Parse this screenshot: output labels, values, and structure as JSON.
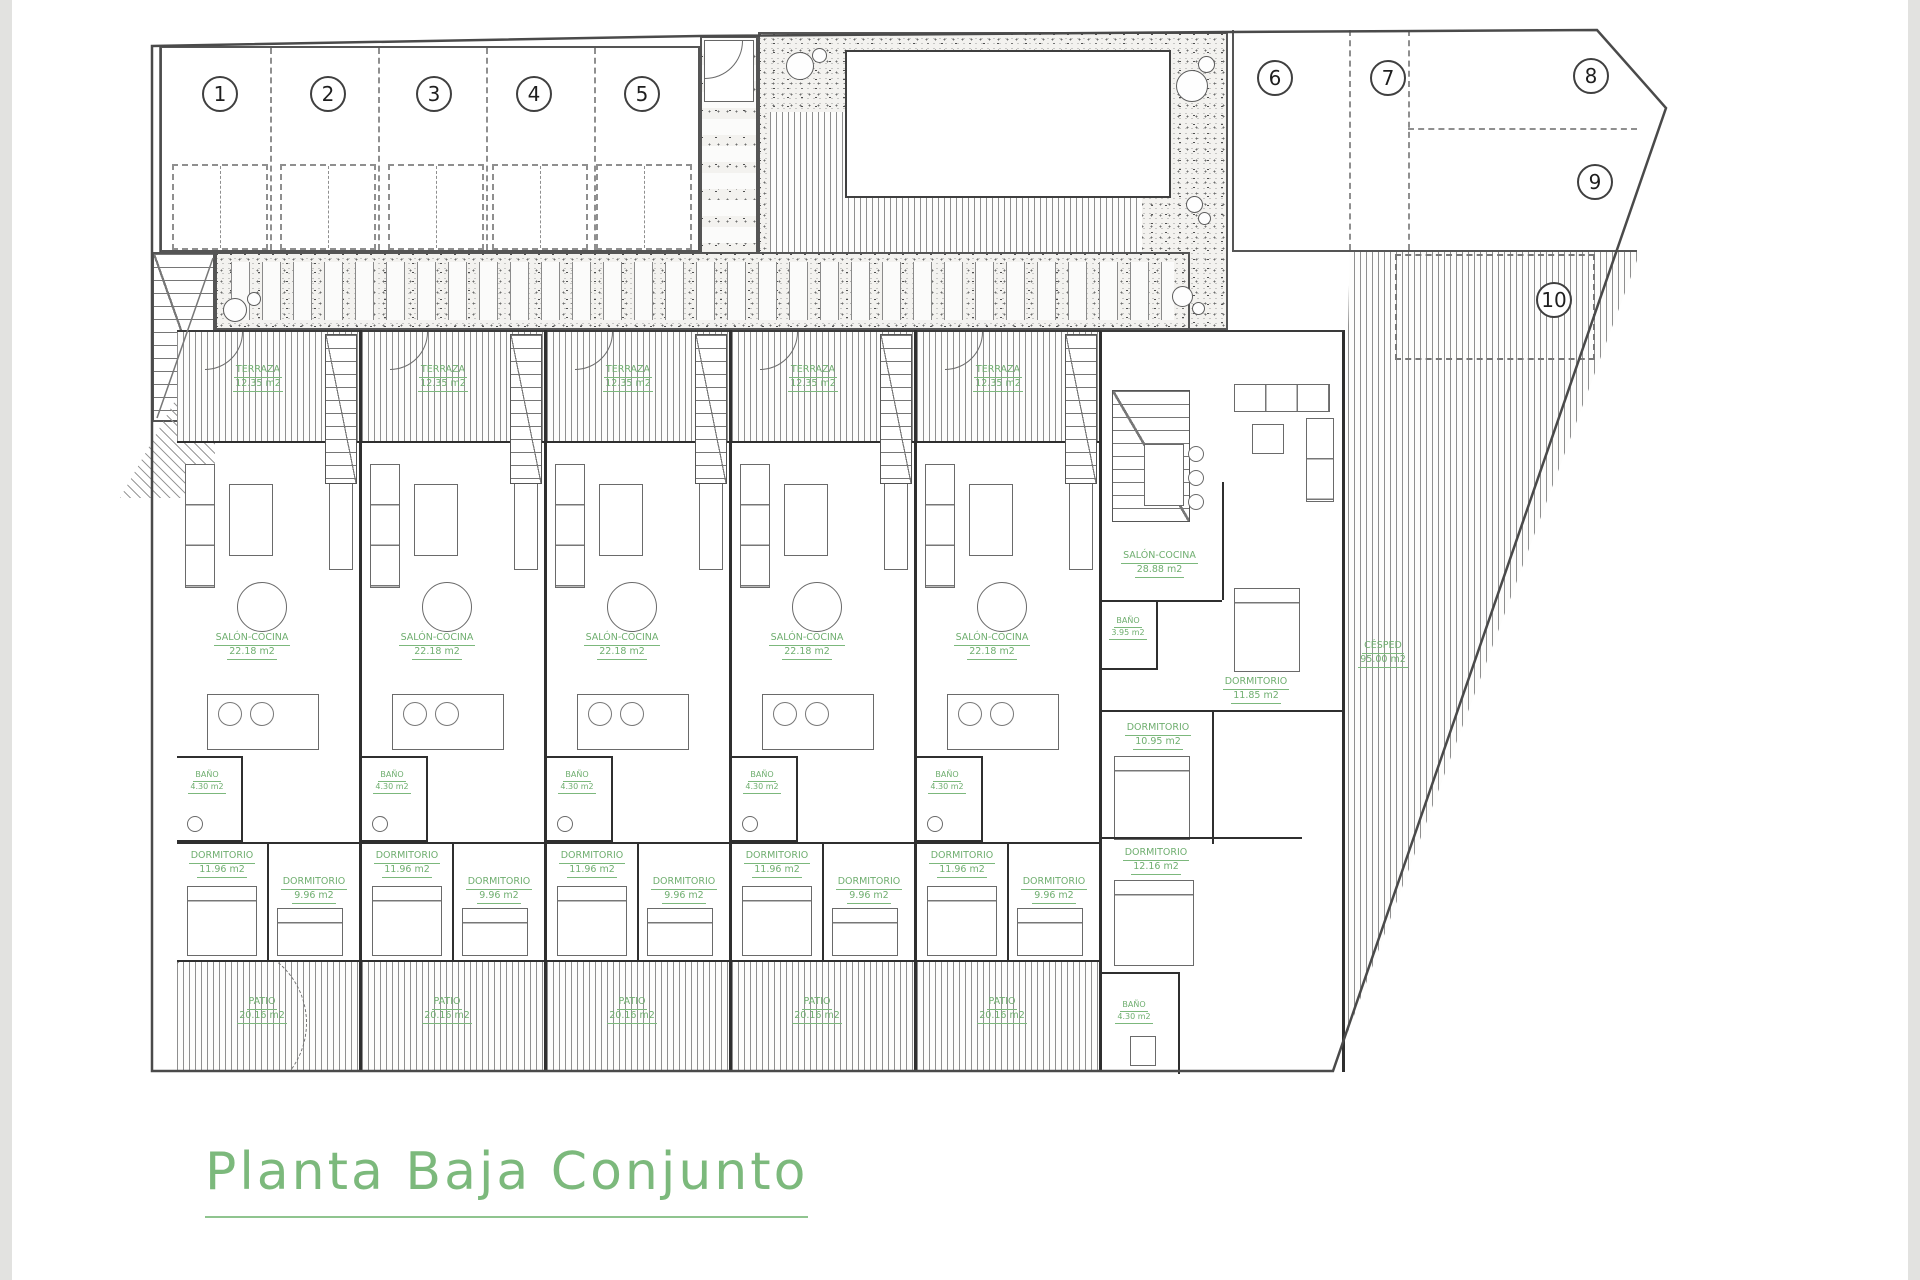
{
  "title": "Planta Baja Conjunto",
  "plot": {
    "parking_numbers": [
      "1",
      "2",
      "3",
      "4",
      "5",
      "6",
      "7",
      "8",
      "9",
      "10"
    ]
  },
  "unit": {
    "terraza": {
      "name": "TERRAZA",
      "area": "12.35 m2"
    },
    "salon": {
      "name": "SALÓN-COCINA",
      "area": "22.18 m2"
    },
    "bano": {
      "name": "BAÑO",
      "area": "4.30 m2"
    },
    "dorm1": {
      "name": "DORMITORIO",
      "area": "11.96 m2"
    },
    "dorm2": {
      "name": "DORMITORIO",
      "area": "9.96 m2"
    },
    "patio": {
      "name": "PATIO",
      "area": "20.16 m2"
    }
  },
  "end_unit": {
    "salon": {
      "name": "SALÓN-COCINA",
      "area": "28.88 m2"
    },
    "bano1": {
      "name": "BAÑO",
      "area": "3.95 m2"
    },
    "dorm1": {
      "name": "DORMITORIO",
      "area": "11.85 m2"
    },
    "dorm2": {
      "name": "DORMITORIO",
      "area": "10.95 m2"
    },
    "dorm3": {
      "name": "DORMITORIO",
      "area": "12.16 m2"
    },
    "bano2": {
      "name": "BAÑO",
      "area": "4.30 m2"
    },
    "cesped": {
      "name": "CÉSPED",
      "area": "95.00 m2"
    }
  },
  "colors": {
    "label_green": "#6fae6f",
    "title_green": "#7cb97c",
    "line_gray": "#4a4a4a"
  }
}
